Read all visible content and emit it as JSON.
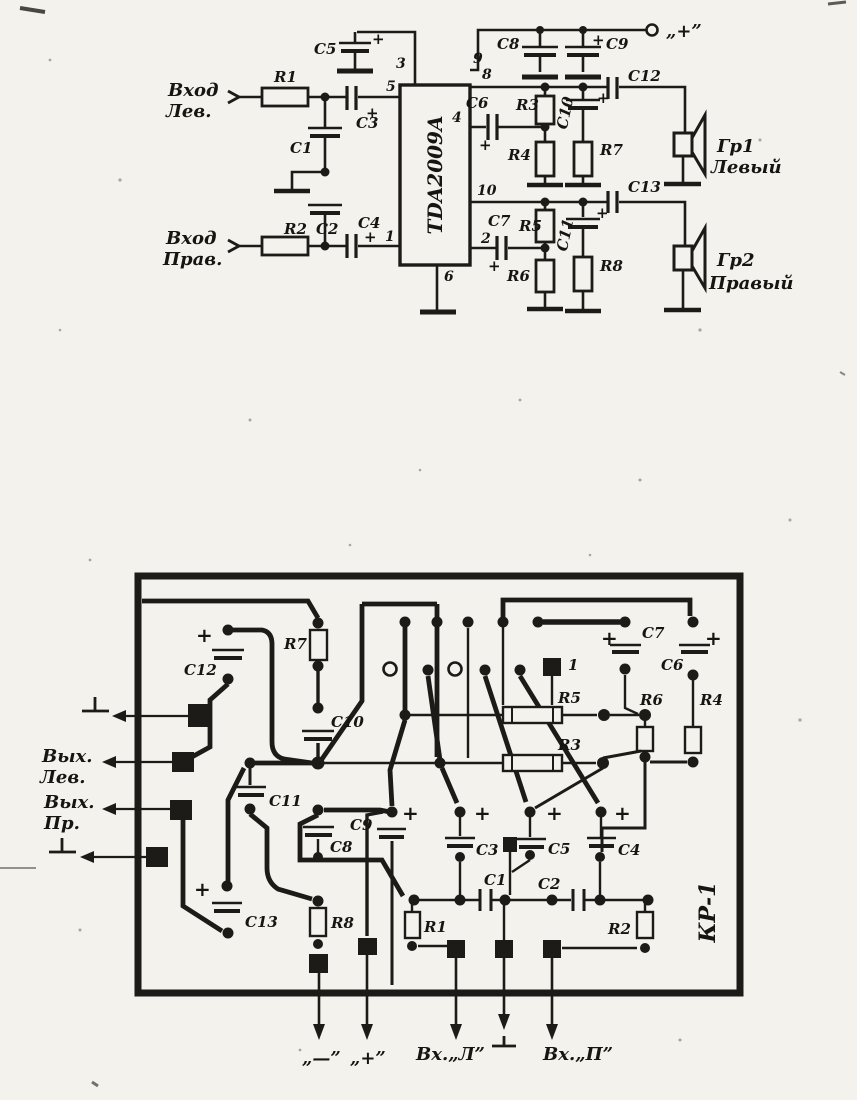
{
  "symbols": {
    "plus": "+"
  },
  "designators": {
    "r1": "R1",
    "r2": "R2",
    "r3": "R3",
    "r4": "R4",
    "r5": "R5",
    "r6": "R6",
    "r7": "R7",
    "r8": "R8",
    "c1": "C1",
    "c2": "C2",
    "c3": "C3",
    "c4": "C4",
    "c5": "C5",
    "c6": "C6",
    "c7": "C7",
    "c8": "C8",
    "c9": "C9",
    "c10": "C10",
    "c11": "C11",
    "c12": "C12",
    "c13": "C13"
  },
  "schematic": {
    "ic_label": "TDA2009A",
    "pins": {
      "p1": "1",
      "p2": "2",
      "p3": "3",
      "p4": "4",
      "p5": "5",
      "p6": "6",
      "p8": "8",
      "p9": "9",
      "p10": "10"
    },
    "labels": {
      "input_left_line1": "Вход",
      "input_left_line2": "Лев.",
      "input_right_line1": "Вход",
      "input_right_line2": "Прав.",
      "supply_plus": "„+”",
      "speaker1_line1": "Гр1",
      "speaker1_line2": "Левый",
      "speaker2_line1": "Гр2",
      "speaker2_line2": "Правый"
    }
  },
  "pcb": {
    "board_label": "КР-1",
    "pin1_marker": "1",
    "io_labels": {
      "out_left_line1": "Вых.",
      "out_left_line2": "Лев.",
      "out_right_line1": "Вых.",
      "out_right_line2": "Пр.",
      "term_minus": "„—”",
      "term_plus": "„+”",
      "term_in_left": "Вх.„Л”",
      "term_in_right": "Вх.„П”"
    }
  }
}
